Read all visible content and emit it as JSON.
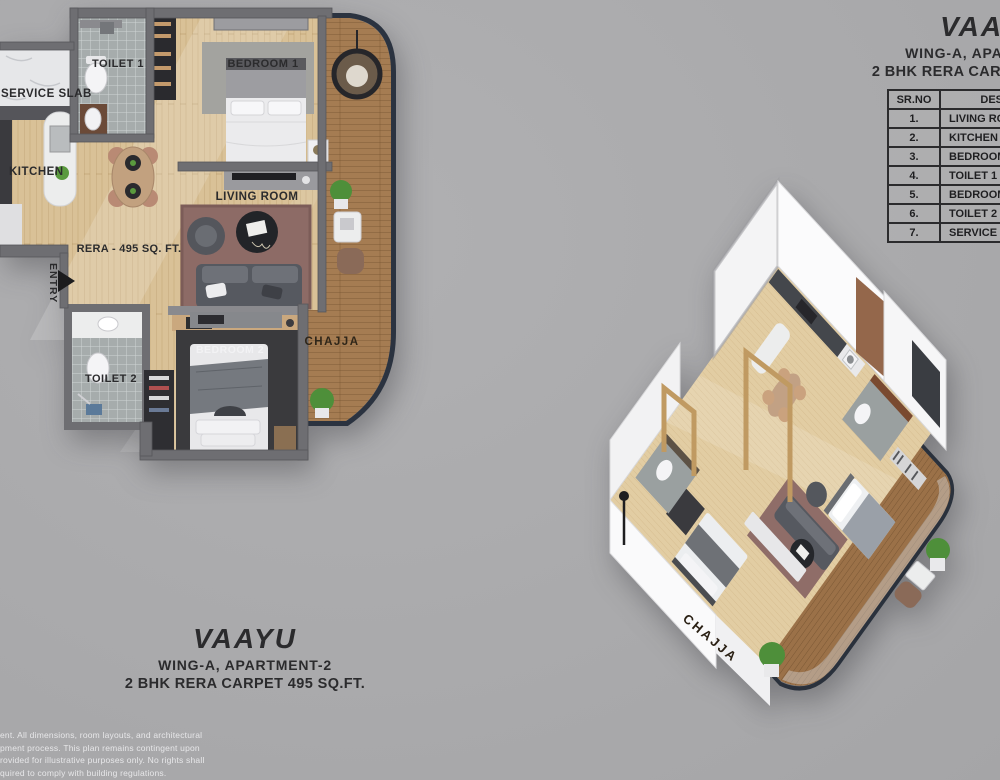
{
  "colors": {
    "background": "#aaaaac",
    "wall_gray": "#6e6e72",
    "wood_floor": "#d9c197",
    "balcony_wood": "#a57c52",
    "balcony_border_navy": "#2b3340",
    "tile_gray": "#a6acac",
    "living_rug_mauve": "#8d6b66",
    "bedroom2_rug_dark": "#3a3a3d",
    "text_dark": "#2b2b2d",
    "disclaimer_text": "#e7e7e9"
  },
  "plan2d": {
    "labels": {
      "toilet1": "TOILET 1",
      "service_slab": "SERVICE SLAB",
      "kitchen": "KITCHEN",
      "bedroom1": "BEDROOM 1",
      "living_room": "LIVING ROOM",
      "rera": "RERA - 495 SQ. FT.",
      "entry": "ENTRY",
      "toilet2": "TOILET 2",
      "bedroom2": "BEDROOM 2",
      "chajja": "CHAJJA"
    },
    "caption": {
      "title": "VAAYU",
      "subtitle": "WING-A, APARTMENT-2",
      "detail": "2 BHK RERA CARPET 495 SQ.FT."
    }
  },
  "view3d": {
    "labels": {
      "chajja": "CHAJJA"
    }
  },
  "header_right": {
    "title": "VAAYU",
    "subtitle": "WING-A, APARTMENT-2",
    "detail": "2 BHK RERA CARPET 495 SQ.FT."
  },
  "room_table": {
    "headers": {
      "sr_no": "SR.NO",
      "description": "DESCRIPTION"
    },
    "rows": [
      {
        "sr": "1.",
        "description": "LIVING ROOM"
      },
      {
        "sr": "2.",
        "description": "KITCHEN"
      },
      {
        "sr": "3.",
        "description": "BEDROOM 1"
      },
      {
        "sr": "4.",
        "description": "TOILET 1"
      },
      {
        "sr": "5.",
        "description": "BEDROOM 2"
      },
      {
        "sr": "6.",
        "description": "TOILET 2"
      },
      {
        "sr": "7.",
        "description": "SERVICE SLAB"
      }
    ]
  },
  "disclaimer": {
    "lines": [
      "ent. All dimensions, room layouts, and architectural",
      "pment process. This plan remains contingent upon",
      "rovided for illustrative purposes only. No rights shall",
      "quired to comply with building regulations."
    ]
  }
}
